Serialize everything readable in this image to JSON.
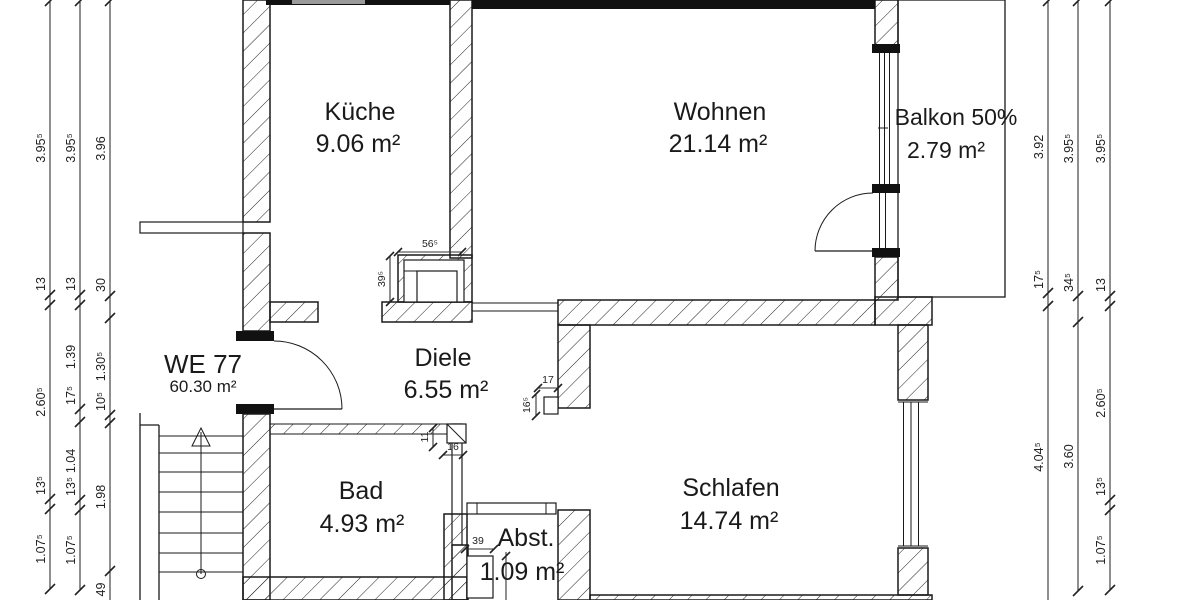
{
  "plan": {
    "apartment": {
      "name": "WE 77",
      "area": "60.30 m²"
    },
    "rooms": {
      "kueche": {
        "name": "Küche",
        "area": "9.06 m²"
      },
      "wohnen": {
        "name": "Wohnen",
        "area": "21.14 m²"
      },
      "balkon": {
        "name": "Balkon 50%",
        "area": "2.79 m²"
      },
      "diele": {
        "name": "Diele",
        "area": "6.55 m²"
      },
      "bad": {
        "name": "Bad",
        "area": "4.93 m²"
      },
      "abst": {
        "name": "Abst.",
        "area": "1.09 m²"
      },
      "schlafen": {
        "name": "Schlafen",
        "area": "14.74 m²"
      }
    },
    "detail_dims": {
      "chimney_w": "56⁵",
      "chimney_h": "39⁵",
      "schlafen_duct_w": "17",
      "schlafen_duct_h": "16⁵",
      "bad_duct_h": "11",
      "bad_duct_w": "16",
      "abst_niche_w": "39"
    },
    "dim_chains": {
      "left": [
        {
          "values": [
            "3.95⁵",
            "13",
            "2.60⁵",
            "13⁵",
            "1.07⁵"
          ]
        },
        {
          "values": [
            "3.95⁵",
            "13",
            "1.39",
            "17⁵",
            "1.04",
            "13⁵",
            "1.07⁵"
          ]
        },
        {
          "values": [
            "3.96",
            "30",
            "1.30⁵",
            "10⁵",
            "1.98",
            "49"
          ]
        }
      ],
      "right": [
        {
          "values": [
            "3.92",
            "17⁵",
            "4.04⁵"
          ]
        },
        {
          "values": [
            "3.95⁵",
            "34⁵",
            "3.60"
          ]
        },
        {
          "values": [
            "3.95⁵",
            "13",
            "2.60⁵",
            "13⁵",
            "1.07⁵"
          ]
        }
      ]
    },
    "colors": {
      "line": "#1a1a1a",
      "bg": "#ffffff"
    }
  }
}
